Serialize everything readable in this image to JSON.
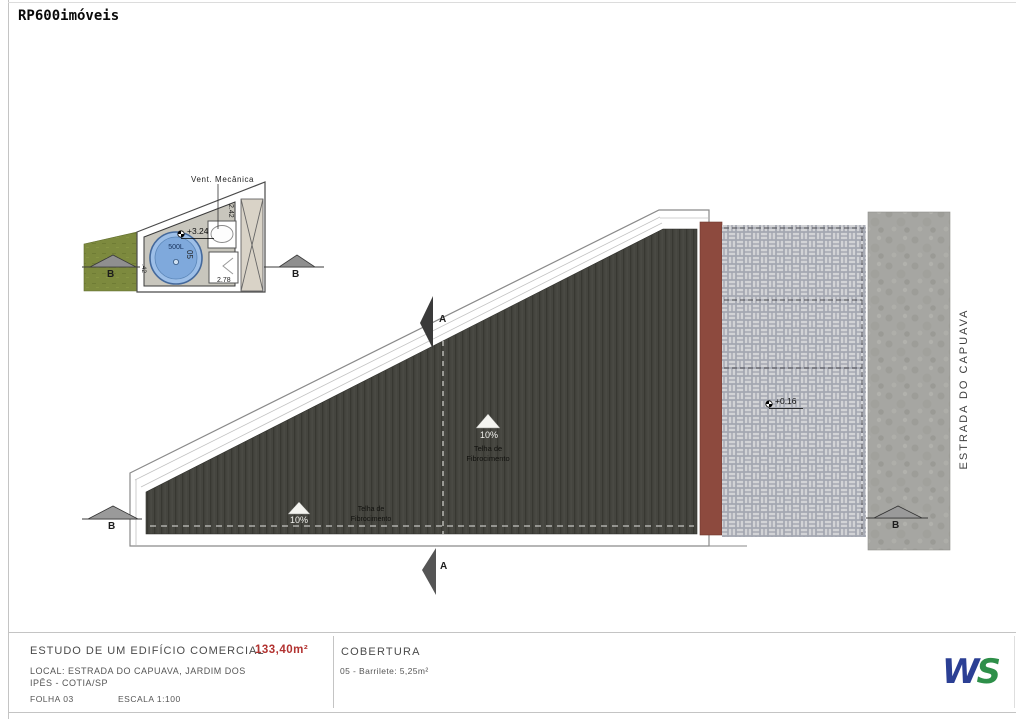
{
  "page": {
    "watermark": "RP600imóveis"
  },
  "detail": {
    "vent_label": "Vent. Mecânica",
    "level_mark": "+3.24",
    "tank_label": "500L",
    "room_number": "05",
    "dim_height": "2.42",
    "dim_width": "2.78",
    "dim_wall": ".42",
    "section_b_label": "B"
  },
  "plan": {
    "slope_percent": "10%",
    "roof_material_line1": "Telha de",
    "roof_material_line2": "Fibrocimento",
    "level_mark": "+0.16",
    "street_name": "ESTRADA DO CAPUAVA",
    "section_a_label": "A",
    "section_b_label": "B"
  },
  "title_block": {
    "project_title": "ESTUDO DE UM EDIFÍCIO COMERCIAL",
    "area_value": "133,40m²",
    "location_line1": "LOCAL: ESTRADA DO CAPUAVA, JARDIM DOS",
    "location_line2": "IPÊS - COTIA/SP",
    "sheet_number": "FOLHA 03",
    "scale": "ESCALA 1:100",
    "sheet_title": "COBERTURA",
    "room_schedule": "05 - Barrilete: 5,25m²",
    "firm_logo_w": "W",
    "firm_logo_s": "S"
  },
  "colors": {
    "roof_dark": "#45453f",
    "wall_red": "#8d4a3e",
    "paver_gray": "#c9cbd2",
    "road_gray": "#a6a6a2",
    "grass_green": "#7d8a3e",
    "tank_blue": "#86aede",
    "area_red": "#b23230",
    "logo_blue": "#2b3f94",
    "logo_green": "#2e8f49"
  }
}
